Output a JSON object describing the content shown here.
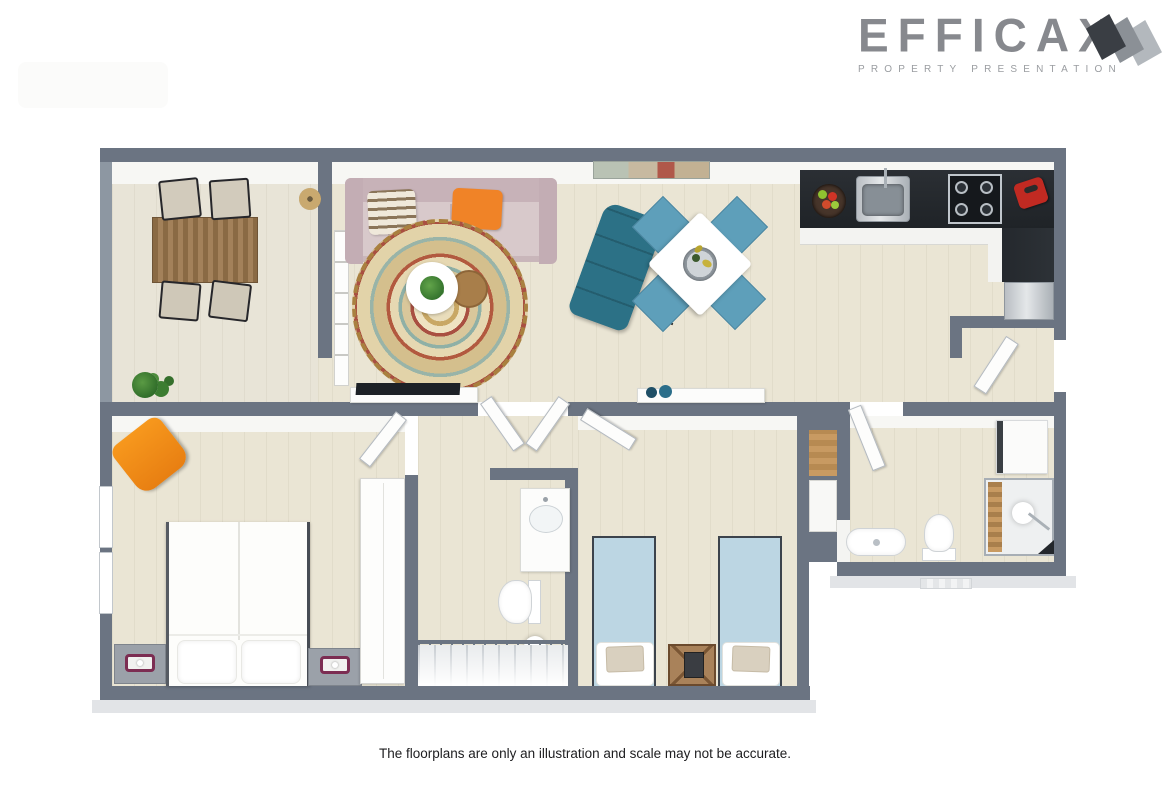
{
  "logo": {
    "title": "EFFICAX",
    "subtitle": "PROPERTY PRESENTATION",
    "mark_colors": [
      "#3a3e44",
      "#8b9096",
      "#b3b8bd"
    ]
  },
  "caption": "The floorplans are only an illustration and scale may not be accurate.",
  "colors": {
    "wall": "#6b7482",
    "floor": "#eae5d4",
    "kitchen_counter": "#23272c",
    "accent_orange": "#f28c17",
    "lounge_teal": "#2c7186",
    "dining_chair_blue": "#5e9fba",
    "bed_blue": "#bcd6e3",
    "sofa_pink": "#c7b2b8",
    "rug_tan": "#cdb383",
    "logo_gray": "#87898e"
  },
  "floorplan": {
    "type": "3d-rendered-apartment-floorplan",
    "rooms": [
      {
        "name": "balcony",
        "furniture": [
          "wood-dining-table",
          "outdoor-chair x4",
          "potted-plant"
        ]
      },
      {
        "name": "living-room",
        "furniture": [
          "pink-sofa",
          "striped-pillow",
          "orange-pillow",
          "round-boho-rug",
          "white-coffee-table",
          "wood-tray",
          "plant",
          "teal-lounge-chair",
          "tv-console",
          "tv",
          "wall-art",
          "shelf-unit",
          "wicker-wall-decor",
          "sideboard-with-decor"
        ]
      },
      {
        "name": "dining-area",
        "furniture": [
          "white-square-table",
          "blue-chair x4",
          "wine-bucket"
        ]
      },
      {
        "name": "kitchen",
        "furniture": [
          "l-shaped-black-counter",
          "sink",
          "cooktop-4-burner",
          "fruit-bowl",
          "red-pot",
          "stainless-appliance"
        ]
      },
      {
        "name": "entry",
        "furniture": [
          "front-door-open"
        ]
      },
      {
        "name": "master-bedroom",
        "furniture": [
          "double-bed",
          "nightstand x2",
          "lamp x2",
          "orange-armchair",
          "tall-wardrobe",
          "window x2",
          "door"
        ]
      },
      {
        "name": "hallway",
        "furniture": [
          "double-doors",
          "staircase",
          "railing",
          "floor-lamp"
        ]
      },
      {
        "name": "inner-bathroom",
        "furniture": [
          "vanity-sink",
          "toilet"
        ]
      },
      {
        "name": "twin-bedroom",
        "furniture": [
          "single-bed-blue x2",
          "wood-nightstand",
          "closet-niche",
          "door"
        ]
      },
      {
        "name": "bathroom",
        "furniture": [
          "washing-machine",
          "shower-enclosure",
          "wood-slats",
          "sink",
          "toilet",
          "door",
          "mat"
        ]
      }
    ]
  }
}
